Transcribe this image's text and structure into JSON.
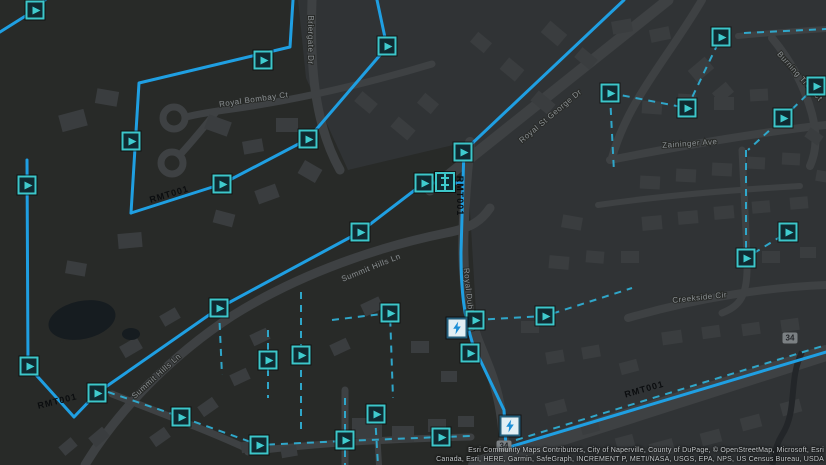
{
  "map": {
    "colors": {
      "background": "#303335",
      "park": "#282a28",
      "road": "#3e4143",
      "building": "#3a3d3f",
      "water": "#161c20",
      "creek": "#232629",
      "street_label": "#8b9093",
      "main_line": "#1f9fe2",
      "lateral_line": "#2fadd2",
      "marker_teal": "#3dc7ca",
      "main_label": "#0b0d0f"
    },
    "park_polygon": "0,0 298,0 306,78 348,170 466,142 477,330 507,415 492,465 0,465",
    "water": {
      "pond": {
        "cx": 82,
        "cy": 320,
        "rx": 34,
        "ry": 19,
        "rot": -12
      },
      "pond_small": {
        "cx": 131,
        "cy": 334,
        "rx": 9,
        "ry": 6,
        "rot": 0
      },
      "creek": "M 802,352 C 788,380 798,410 782,435 C 774,448 776,456 772,465"
    },
    "roads": [
      {
        "d": "M 312,0 C 310,60 313,122 340,170",
        "w": 9
      },
      {
        "d": "M 430,190 L 668,0",
        "w": 11
      },
      {
        "d": "M 470,142 C 461,230 459,288 477,338 C 489,370 504,392 505,465",
        "w": 10
      },
      {
        "d": "M 610,160 C 690,144 770,131 826,125",
        "w": 8
      },
      {
        "d": "M 702,0 C 668,58 628,100 612,158",
        "w": 8
      },
      {
        "d": "M 432,64 C 352,88 282,102 232,109 C 210,112 198,114 186,117",
        "w": 7
      },
      {
        "d": "M 216,112 C 202,130 188,146 179,156",
        "w": 7
      },
      {
        "d": "M 85,465 C 112,420 162,362 232,316 C 302,272 382,246 446,233 C 472,228 482,220 490,208",
        "w": 9
      },
      {
        "d": "M 628,318 C 700,297 772,287 826,285",
        "w": 8
      },
      {
        "d": "M 772,38 C 792,62 805,88 812,114 C 817,134 817,150 810,166",
        "w": 8
      },
      {
        "d": "M 476,465 L 826,353",
        "w": 16
      },
      {
        "d": "M 345,390 L 345,465",
        "w": 7
      },
      {
        "d": "M 248,452 C 310,444 390,439 471,437",
        "w": 7
      },
      {
        "d": "M 112,394 C 158,412 212,432 252,451",
        "w": 7
      },
      {
        "d": "M 742,150 C 744,192 746,226 747,262 C 748,296 740,306 722,313",
        "w": 7
      },
      {
        "d": "M 738,36 C 780,32 812,30 826,29",
        "w": 6
      },
      {
        "d": "M 376,414 L 379,465",
        "w": 6
      },
      {
        "d": "M 598,205 C 660,196 730,190 800,186",
        "w": 6
      }
    ],
    "culdesacs": [
      {
        "cx": 174,
        "cy": 118,
        "r": 11
      },
      {
        "cx": 172,
        "cy": 163,
        "r": 11
      }
    ],
    "buildings": [
      [
        60,
        112,
        26,
        17,
        -15
      ],
      [
        96,
        90,
        22,
        15,
        10
      ],
      [
        206,
        118,
        24,
        15,
        20
      ],
      [
        243,
        140,
        20,
        13,
        -10
      ],
      [
        276,
        118,
        22,
        14,
        0
      ],
      [
        300,
        164,
        20,
        15,
        30
      ],
      [
        256,
        187,
        22,
        14,
        -20
      ],
      [
        214,
        212,
        20,
        13,
        15
      ],
      [
        118,
        233,
        24,
        15,
        -5
      ],
      [
        66,
        262,
        20,
        13,
        10
      ],
      [
        356,
        96,
        20,
        13,
        40
      ],
      [
        392,
        122,
        22,
        13,
        40
      ],
      [
        419,
        97,
        18,
        13,
        40
      ],
      [
        543,
        26,
        22,
        15,
        40
      ],
      [
        576,
        52,
        20,
        13,
        40
      ],
      [
        502,
        62,
        20,
        15,
        40
      ],
      [
        532,
        96,
        22,
        13,
        40
      ],
      [
        472,
        36,
        18,
        13,
        40
      ],
      [
        612,
        20,
        20,
        13,
        -10
      ],
      [
        650,
        28,
        20,
        13,
        -12
      ],
      [
        690,
        62,
        22,
        15,
        -40
      ],
      [
        714,
        86,
        18,
        13,
        -40
      ],
      [
        642,
        101,
        20,
        13,
        4
      ],
      [
        678,
        94,
        18,
        12,
        3
      ],
      [
        714,
        97,
        20,
        13,
        0
      ],
      [
        750,
        89,
        18,
        12,
        -3
      ],
      [
        640,
        176,
        20,
        13,
        3
      ],
      [
        676,
        169,
        20,
        13,
        3
      ],
      [
        712,
        163,
        20,
        13,
        3
      ],
      [
        747,
        157,
        18,
        12,
        3
      ],
      [
        782,
        153,
        18,
        12,
        3
      ],
      [
        642,
        216,
        20,
        14,
        -5
      ],
      [
        678,
        211,
        20,
        13,
        -5
      ],
      [
        714,
        206,
        20,
        13,
        -5
      ],
      [
        752,
        201,
        18,
        12,
        -5
      ],
      [
        790,
        197,
        18,
        12,
        -5
      ],
      [
        562,
        216,
        20,
        13,
        10
      ],
      [
        549,
        256,
        20,
        13,
        5
      ],
      [
        586,
        251,
        18,
        12,
        5
      ],
      [
        621,
        251,
        18,
        12,
        0
      ],
      [
        762,
        251,
        18,
        12,
        0
      ],
      [
        800,
        247,
        16,
        11,
        0
      ],
      [
        662,
        331,
        20,
        13,
        -8
      ],
      [
        702,
        326,
        18,
        12,
        -8
      ],
      [
        742,
        323,
        18,
        12,
        -8
      ],
      [
        781,
        319,
        18,
        12,
        -8
      ],
      [
        521,
        321,
        18,
        12,
        0
      ],
      [
        546,
        351,
        18,
        12,
        -10
      ],
      [
        582,
        346,
        18,
        12,
        -10
      ],
      [
        620,
        361,
        18,
        12,
        -15
      ],
      [
        362,
        300,
        20,
        13,
        -25
      ],
      [
        331,
        341,
        18,
        12,
        -25
      ],
      [
        251,
        331,
        18,
        12,
        -25
      ],
      [
        231,
        371,
        18,
        12,
        -25
      ],
      [
        199,
        401,
        18,
        12,
        -35
      ],
      [
        151,
        431,
        18,
        12,
        -35
      ],
      [
        121,
        341,
        20,
        13,
        -30
      ],
      [
        161,
        311,
        18,
        12,
        -30
      ],
      [
        411,
        341,
        18,
        12,
        0
      ],
      [
        441,
        371,
        16,
        11,
        0
      ],
      [
        352,
        418,
        30,
        20,
        0
      ],
      [
        392,
        426,
        22,
        16,
        0
      ],
      [
        428,
        419,
        18,
        13,
        0
      ],
      [
        458,
        416,
        16,
        11,
        0
      ],
      [
        546,
        401,
        20,
        13,
        -15
      ],
      [
        581,
        421,
        18,
        12,
        -15
      ],
      [
        616,
        436,
        18,
        12,
        -15
      ],
      [
        650,
        441,
        24,
        15,
        -15
      ],
      [
        701,
        431,
        20,
        13,
        -15
      ],
      [
        741,
        416,
        20,
        13,
        -15
      ],
      [
        781,
        401,
        20,
        13,
        -15
      ],
      [
        806,
        131,
        16,
        11,
        35
      ],
      [
        816,
        171,
        15,
        11,
        10
      ],
      [
        90,
        431,
        18,
        12,
        -40
      ],
      [
        60,
        441,
        16,
        11,
        -40
      ],
      [
        241,
        441,
        16,
        11,
        -10
      ],
      [
        281,
        446,
        16,
        11,
        -10
      ]
    ],
    "streets": [
      {
        "label": "Briergate Dr",
        "x": 308,
        "y": 40,
        "rot": 90
      },
      {
        "label": "Royal Bombay Ct",
        "x": 254,
        "y": 102,
        "rot": -8
      },
      {
        "label": "Royal St George Dr",
        "x": 552,
        "y": 118,
        "rot": -40
      },
      {
        "label": "Zaininger Ave",
        "x": 690,
        "y": 146,
        "rot": -4
      },
      {
        "label": "Summit Hills Ln",
        "x": 372,
        "y": 270,
        "rot": -22
      },
      {
        "label": "Summit Hills Ln",
        "x": 158,
        "y": 378,
        "rot": -42
      },
      {
        "label": "Creekside Cir",
        "x": 700,
        "y": 300,
        "rot": -6
      },
      {
        "label": "Burning Tree Ct",
        "x": 798,
        "y": 78,
        "rot": 48
      },
      {
        "label": "Royal Dublin Ln",
        "x": 467,
        "y": 300,
        "rot": 84
      }
    ],
    "laterals": [
      [
        [
          610,
          93
        ],
        [
          687,
          108
        ],
        [
          721,
          37
        ]
      ],
      [
        [
          744,
          33
        ],
        [
          826,
          29
        ]
      ],
      [
        [
          816,
          86
        ],
        [
          783,
          118
        ],
        [
          748,
          150
        ]
      ],
      [
        [
          746,
          150
        ],
        [
          746,
          258
        ],
        [
          788,
          232
        ]
      ],
      [
        [
          610,
          95
        ],
        [
          614,
          172
        ]
      ],
      [
        [
          475,
          320
        ],
        [
          545,
          316
        ],
        [
          632,
          288
        ]
      ],
      [
        [
          516,
          440
        ],
        [
          826,
          345
        ]
      ],
      [
        [
          108,
          392
        ],
        [
          181,
          417
        ],
        [
          259,
          445
        ],
        [
          345,
          441
        ],
        [
          441,
          437
        ],
        [
          470,
          436
        ]
      ],
      [
        [
          345,
          398
        ],
        [
          345,
          465
        ]
      ],
      [
        [
          301,
          292
        ],
        [
          301,
          430
        ]
      ],
      [
        [
          268,
          330
        ],
        [
          268,
          398
        ]
      ],
      [
        [
          332,
          320
        ],
        [
          390,
          313
        ],
        [
          393,
          398
        ]
      ],
      [
        [
          375,
          415
        ],
        [
          378,
          465
        ]
      ],
      [
        [
          219,
          310
        ],
        [
          222,
          375
        ]
      ]
    ],
    "mains": [
      "M 45,0 L 35,10 L 0,32",
      "M 293,0 L 290,47 L 139,83 L 131,213",
      "M 131,213 L 222,184 L 308,139 L 387,47 L 377,0",
      "M 27,160 L 28,366 L 74,417 L 97,393 L 219,308 L 360,232 L 424,183 L 462,183",
      "M 463,152 L 624,0",
      "M 464,147 L 461,252 C 461,292 464,316 473,345 L 504,410 L 506,448 L 826,352"
    ],
    "main_labels": [
      {
        "text": "RMT001",
        "x": 170,
        "y": 197,
        "rot": -17
      },
      {
        "text": "RMT001",
        "x": 457,
        "y": 196,
        "rot": 90
      },
      {
        "text": "RMT001",
        "x": 58,
        "y": 404,
        "rot": -14
      },
      {
        "text": "RMT001",
        "x": 645,
        "y": 392,
        "rot": -16
      }
    ],
    "markers": [
      {
        "x": 35,
        "y": 10,
        "t": "flow"
      },
      {
        "x": 263,
        "y": 60,
        "t": "flow"
      },
      {
        "x": 387,
        "y": 46,
        "t": "flow"
      },
      {
        "x": 131,
        "y": 141,
        "t": "flow"
      },
      {
        "x": 222,
        "y": 184,
        "t": "flow"
      },
      {
        "x": 308,
        "y": 139,
        "t": "flow"
      },
      {
        "x": 27,
        "y": 185,
        "t": "flow"
      },
      {
        "x": 29,
        "y": 366,
        "t": "flow"
      },
      {
        "x": 97,
        "y": 393,
        "t": "flow"
      },
      {
        "x": 219,
        "y": 308,
        "t": "flow"
      },
      {
        "x": 360,
        "y": 232,
        "t": "flow"
      },
      {
        "x": 424,
        "y": 183,
        "t": "flow"
      },
      {
        "x": 463,
        "y": 152,
        "t": "flow"
      },
      {
        "x": 475,
        "y": 320,
        "t": "flow"
      },
      {
        "x": 545,
        "y": 316,
        "t": "flow"
      },
      {
        "x": 470,
        "y": 353,
        "t": "flow"
      },
      {
        "x": 610,
        "y": 93,
        "t": "flow"
      },
      {
        "x": 687,
        "y": 108,
        "t": "flow"
      },
      {
        "x": 721,
        "y": 37,
        "t": "flow"
      },
      {
        "x": 816,
        "y": 86,
        "t": "flow"
      },
      {
        "x": 783,
        "y": 118,
        "t": "flow"
      },
      {
        "x": 746,
        "y": 258,
        "t": "flow"
      },
      {
        "x": 788,
        "y": 232,
        "t": "flow"
      },
      {
        "x": 181,
        "y": 417,
        "t": "flow"
      },
      {
        "x": 259,
        "y": 445,
        "t": "flow"
      },
      {
        "x": 345,
        "y": 440,
        "t": "flow"
      },
      {
        "x": 376,
        "y": 414,
        "t": "flow"
      },
      {
        "x": 441,
        "y": 437,
        "t": "flow"
      },
      {
        "x": 268,
        "y": 360,
        "t": "flow"
      },
      {
        "x": 301,
        "y": 355,
        "t": "flow"
      },
      {
        "x": 390,
        "y": 313,
        "t": "flow"
      },
      {
        "x": 445,
        "y": 182,
        "t": "fitting"
      },
      {
        "x": 457,
        "y": 328,
        "t": "pump"
      },
      {
        "x": 510,
        "y": 426,
        "t": "pump"
      }
    ],
    "shields": [
      {
        "x": 504,
        "y": 446,
        "label": "34"
      },
      {
        "x": 790,
        "y": 338,
        "label": "34"
      }
    ],
    "attribution": {
      "line1": "Esri Community Maps Contributors, City of Naperville, County of DuPage, © OpenStreetMap, Microsoft, Esri",
      "line2": "Canada, Esri, HERE, Garmin, SafeGraph, INCREMENT P, METI/NASA, USGS, EPA, NPS, US Census Bureau, USDA"
    }
  }
}
